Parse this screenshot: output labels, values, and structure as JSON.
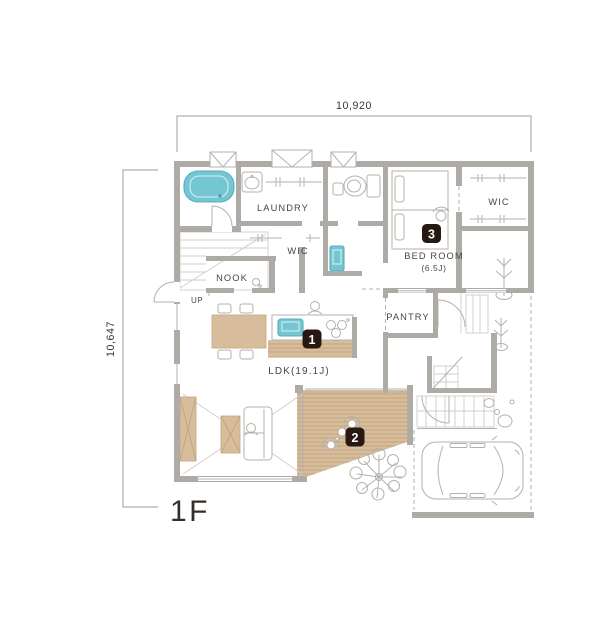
{
  "floor_plan": {
    "floor_label": "1F",
    "dimensions": {
      "width": "10,920",
      "height": "10,647"
    },
    "rooms": {
      "laundry": "LAUNDRY",
      "wic_hall": "WIC",
      "nook": "NOOK",
      "bedroom": "BED ROOM",
      "bedroom_size": "(6.5J)",
      "wic_bedroom": "WIC",
      "pantry": "PANTRY",
      "ldk": "LDK(19.1J)",
      "stairs_up": "UP"
    },
    "markers": [
      {
        "label": "1"
      },
      {
        "label": "2"
      },
      {
        "label": "3"
      }
    ],
    "colors": {
      "wall": "#aeaba7",
      "wood": "#d8bd9c",
      "water": "#74c6d3",
      "marker_bg": "#271912",
      "text": "#4c4541"
    }
  }
}
